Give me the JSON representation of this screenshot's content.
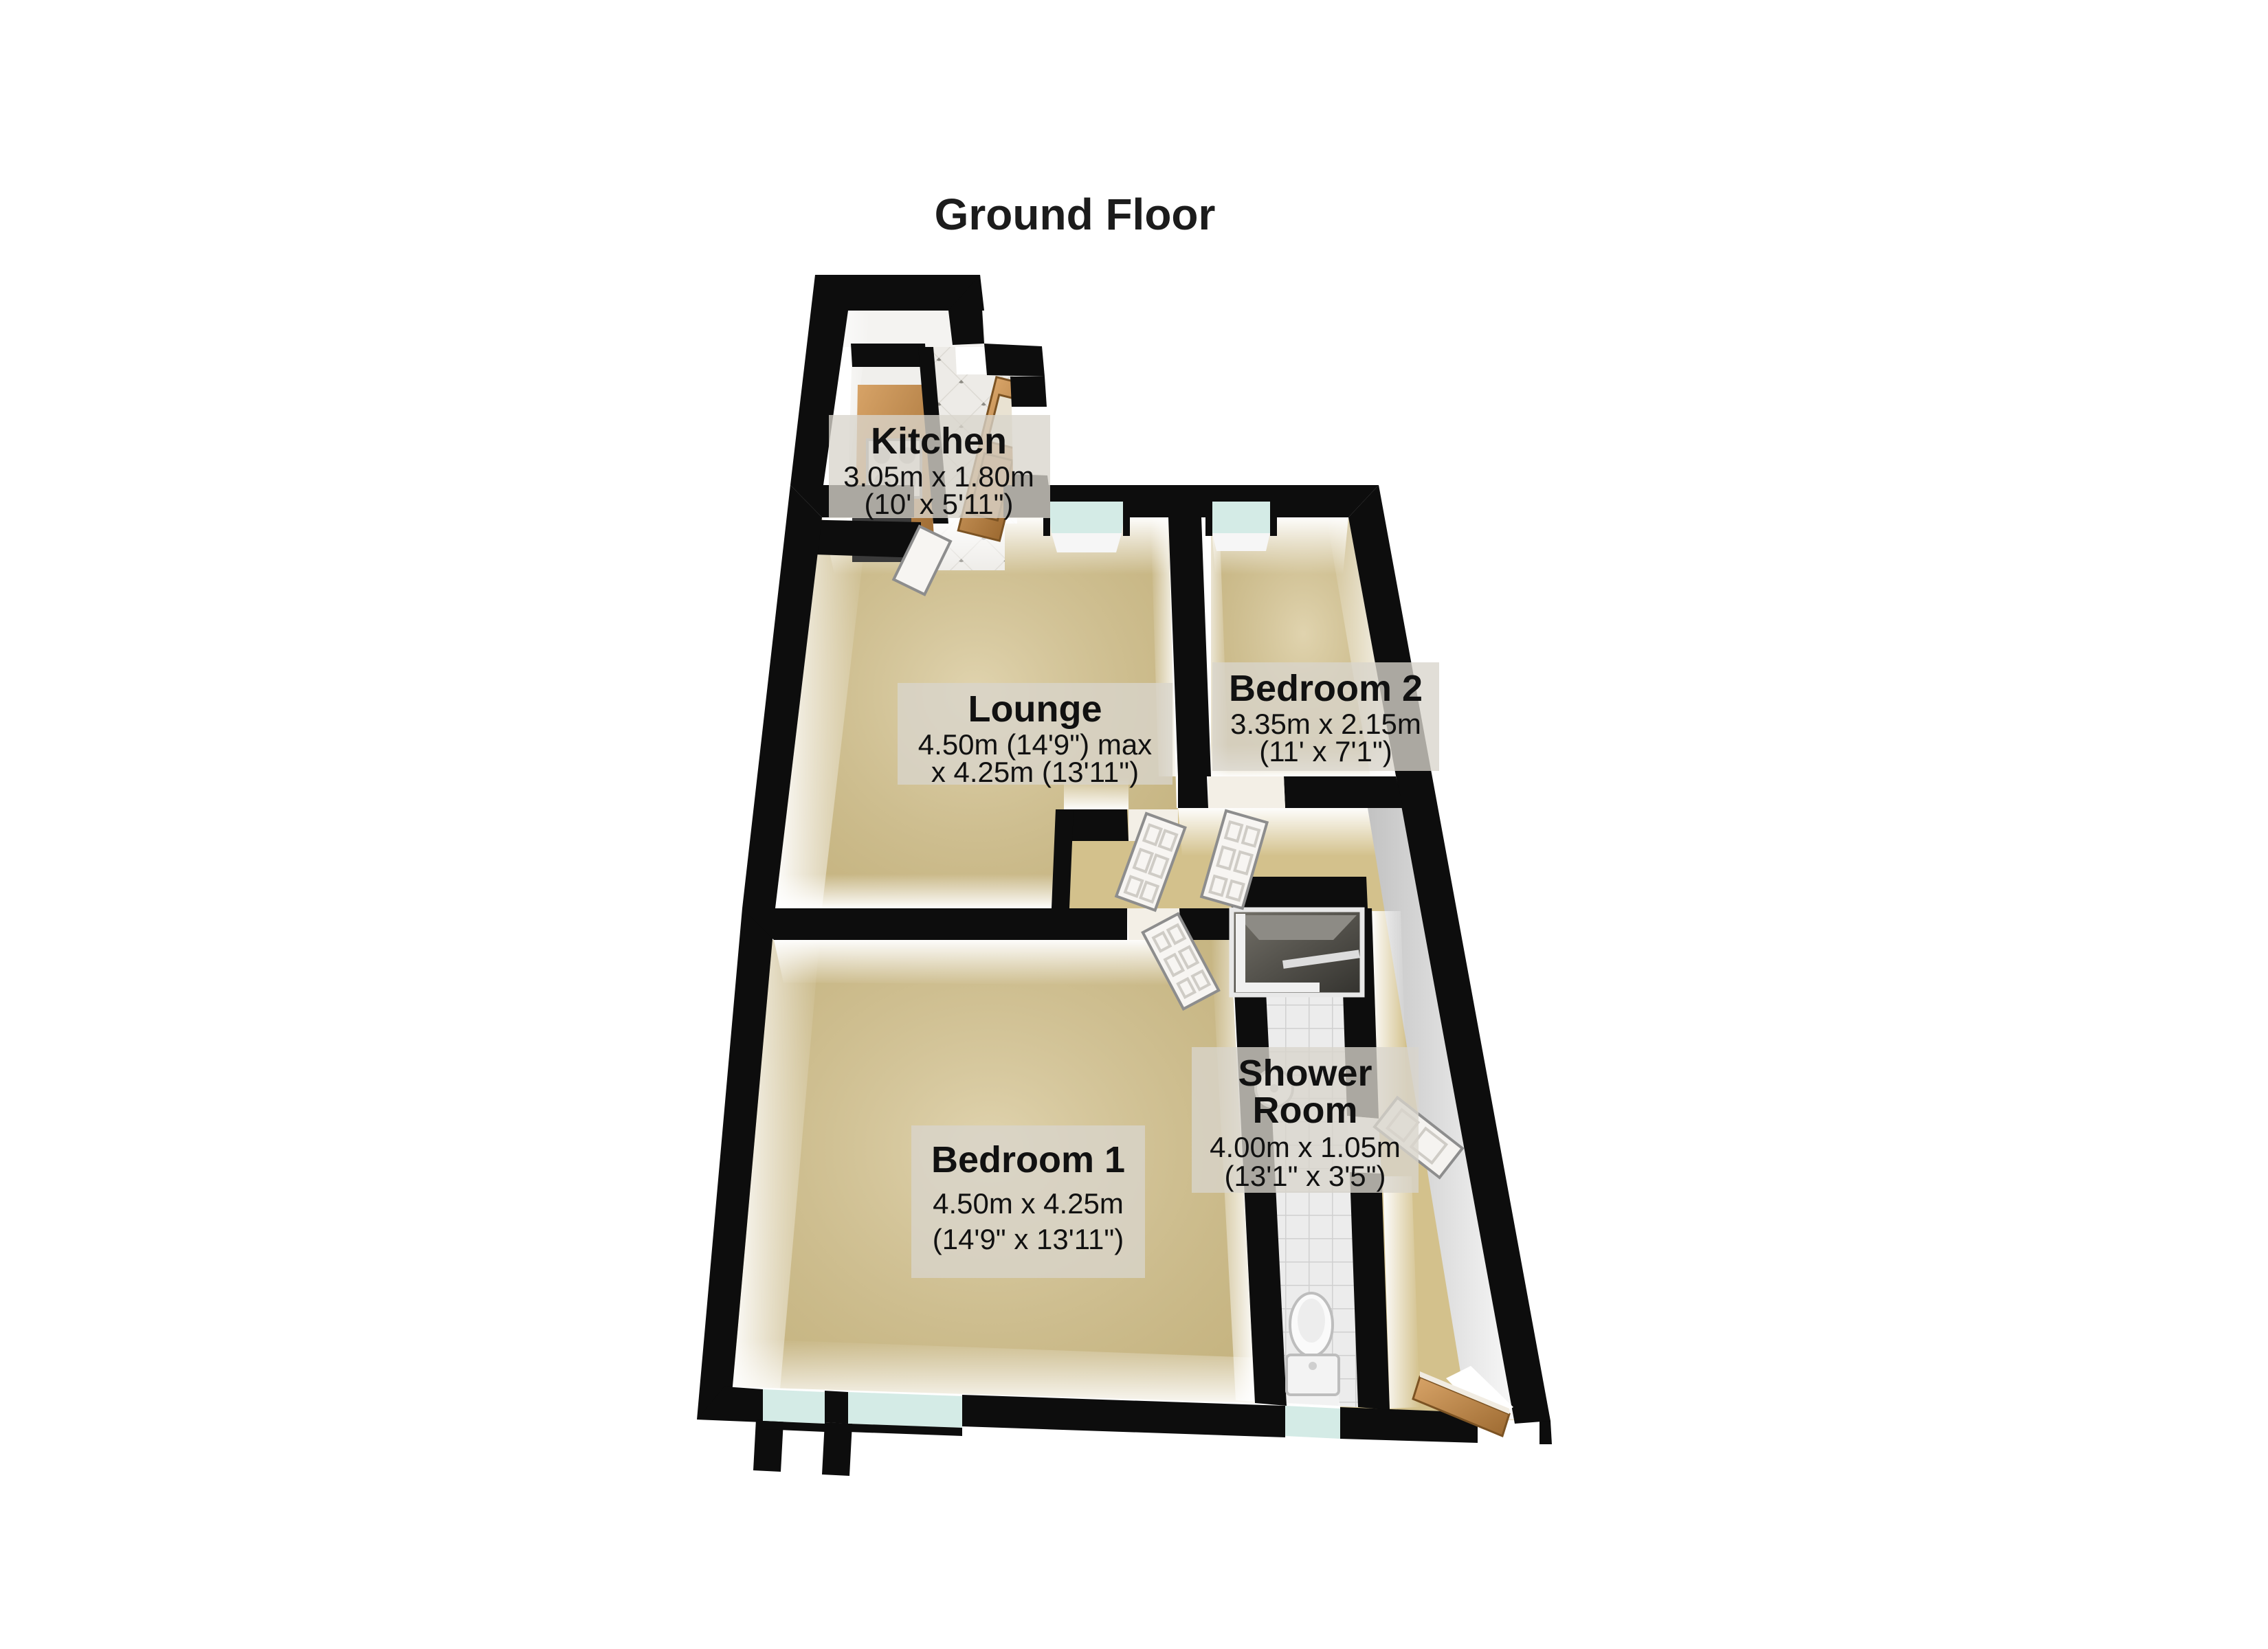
{
  "title": "Ground Floor",
  "rooms": {
    "kitchen": {
      "lines": [
        "Kitchen",
        "3.05m x 1.80m",
        "(10' x 5'11\")"
      ]
    },
    "lounge": {
      "lines": [
        "Lounge",
        "4.50m (14'9\") max",
        "x 4.25m (13'11\")"
      ]
    },
    "bedroom2": {
      "lines": [
        "Bedroom 2",
        "3.35m x 2.15m",
        "(11' x 7'1\")"
      ]
    },
    "bedroom1": {
      "lines": [
        "Bedroom 1",
        "4.50m x 4.25m",
        "(14'9\" x 13'11\")"
      ]
    },
    "shower": {
      "lines": [
        "Shower",
        "Room",
        "4.00m x 1.05m",
        "(13'1\" x 3'5\")"
      ]
    }
  },
  "colors": {
    "wall": "#0d0d0d",
    "floor": "#d3c18c",
    "window_glass": "#d4ebe6",
    "wood": "#c08a4b",
    "tile": "#ebe9e5",
    "shower_tile": "#e9e9e9",
    "label_bg": "#d8d5cc",
    "text": "#111111"
  },
  "fixtures": {
    "kitchen": [
      "counter",
      "stove",
      "front-door-wood",
      "tiled-entry"
    ],
    "shower_room": [
      "shower-cubicle",
      "washbasin",
      "toilet",
      "tiled-floor"
    ],
    "hall": [
      "lounge-door",
      "bedroom2-door",
      "bedroom1-door",
      "shower-door",
      "entrance-door"
    ]
  }
}
